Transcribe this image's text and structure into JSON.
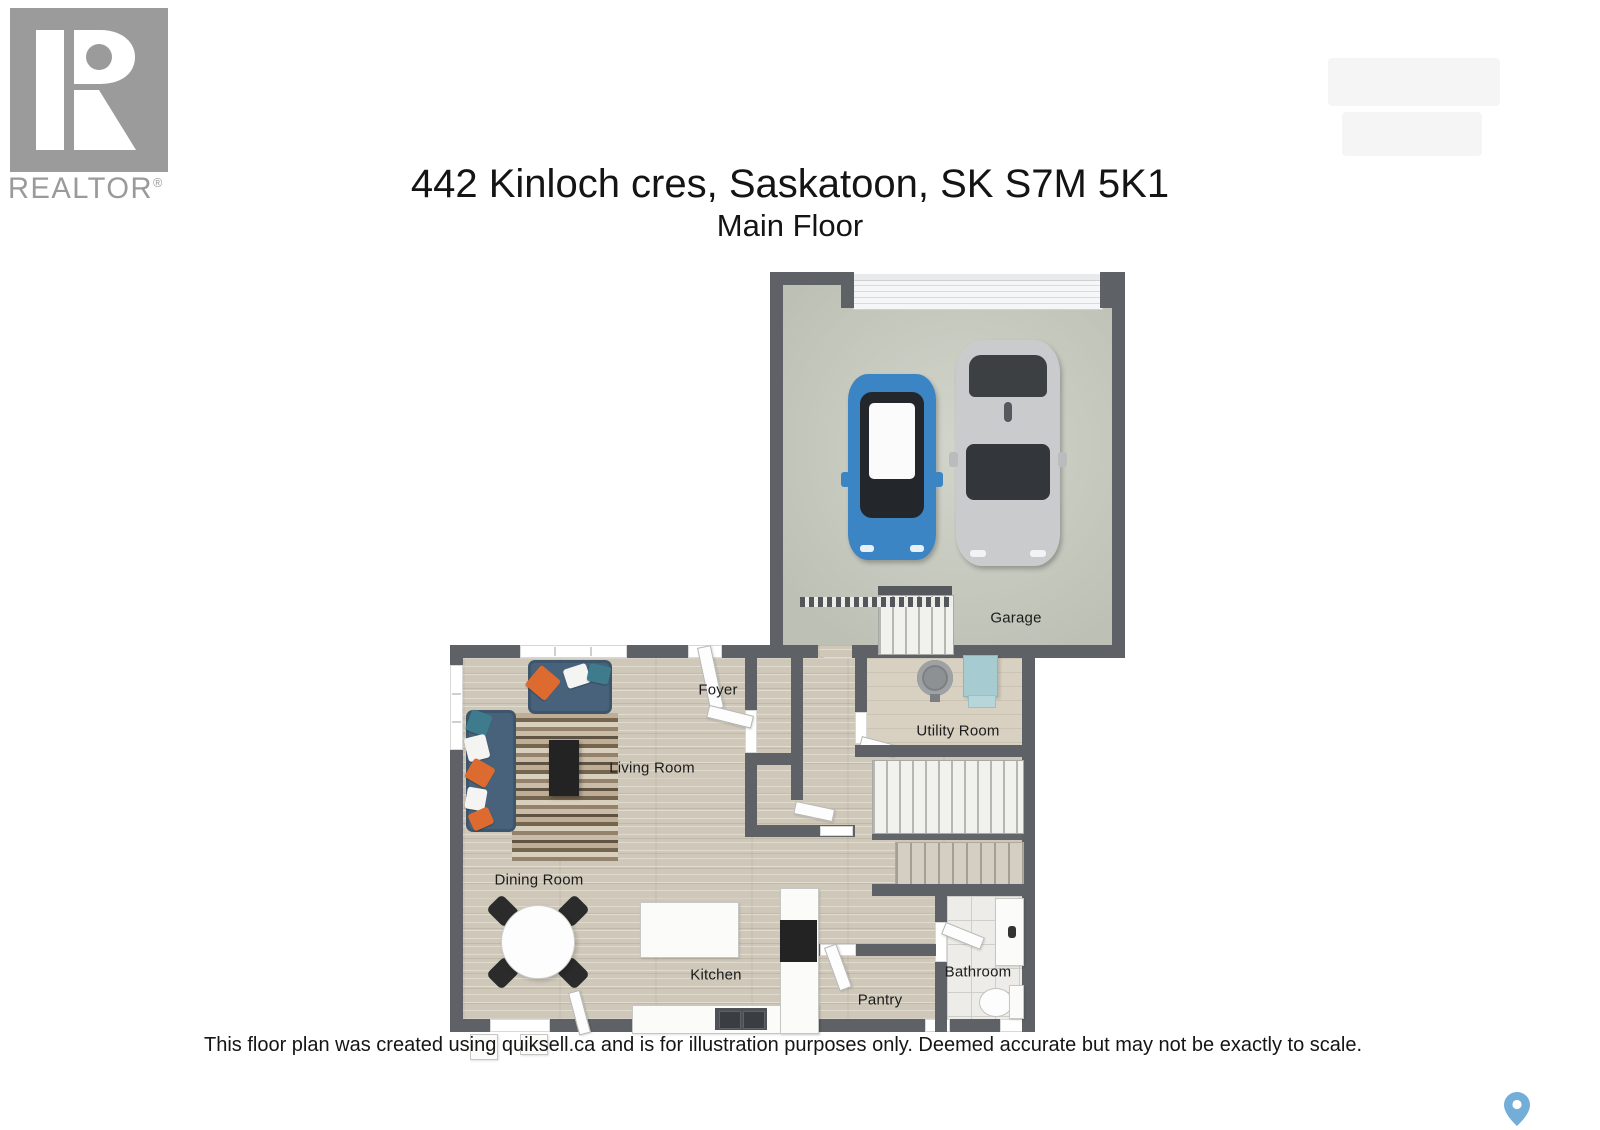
{
  "header": {
    "address": "442 Kinloch cres, Saskatoon, SK S7M 5K1",
    "floor_label": "Main Floor"
  },
  "branding": {
    "realtor_text": "REALTOR",
    "registered_mark": "®"
  },
  "floorplan": {
    "rooms": {
      "garage": "Garage",
      "foyer": "Foyer",
      "living_room": "Living Room",
      "utility_room": "Utility Room",
      "dining_room": "Dining Room",
      "kitchen": "Kitchen",
      "pantry": "Pantry",
      "bathroom": "Bathroom"
    }
  },
  "footer": {
    "disclaimer": "This floor plan was created using quiksell.ca and is for illustration purposes only. Deemed accurate but may not be exactly to scale."
  },
  "colors": {
    "wall": "#5e6267",
    "wood_floor": "#cfc8b9",
    "utility_floor": "#d8d1c2",
    "garage_floor": "#c9ccc0",
    "tile_floor": "#edece8",
    "sofa": "#47627a",
    "pillow_orange": "#dd6a2e",
    "pillow_teal": "#3e7b8c",
    "car_blue": "#3c85c4",
    "car_silver": "#c9cbcd",
    "furnace_teal": "#a6cbd1",
    "map_pin": "#73aed9",
    "logo_gray": "#9b9b9b"
  }
}
